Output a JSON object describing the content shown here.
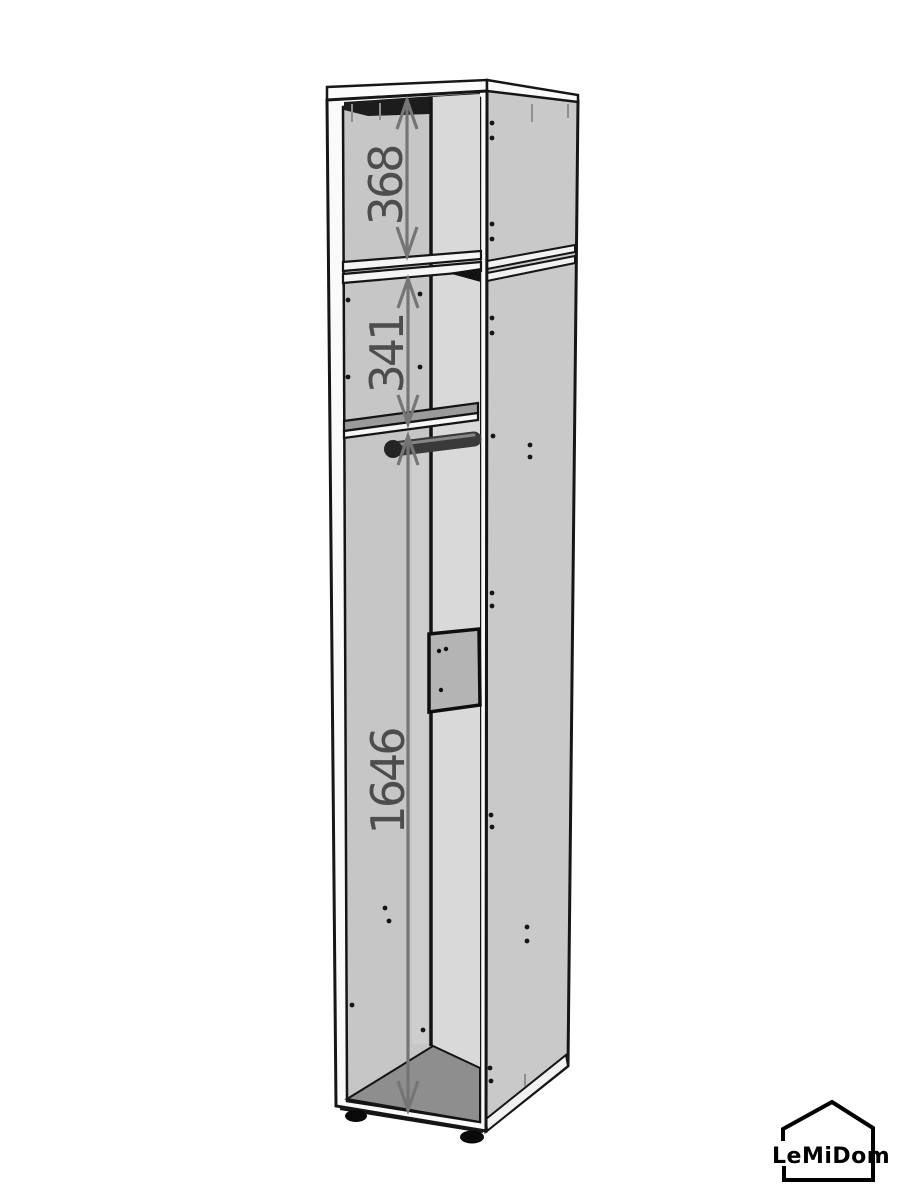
{
  "diagram": {
    "dimensions": [
      {
        "name": "upper-compartment-height",
        "label": "368"
      },
      {
        "name": "middle-compartment-height",
        "label": "341"
      },
      {
        "name": "lower-compartment-height",
        "label": "1646"
      }
    ],
    "logo": {
      "text": "LeMiDom",
      "icon": "house-outline-icon"
    },
    "colors": {
      "background": "#ffffff",
      "outline": "#161616",
      "side_panel": "#c9c9c9",
      "interior_back_wall": "#c6c6c6",
      "interior_right_panel": "#d9d9d9",
      "shelf_top": "#9b9b9b",
      "floor": "#8e8e8e",
      "top_shadow": "#1c1c1c",
      "mount_panel": "#b4b4b4",
      "rod": "#3a3a3a",
      "dimension_line": "#757575",
      "dimension_text": "#4d4d4d",
      "logo": "#000000"
    }
  }
}
